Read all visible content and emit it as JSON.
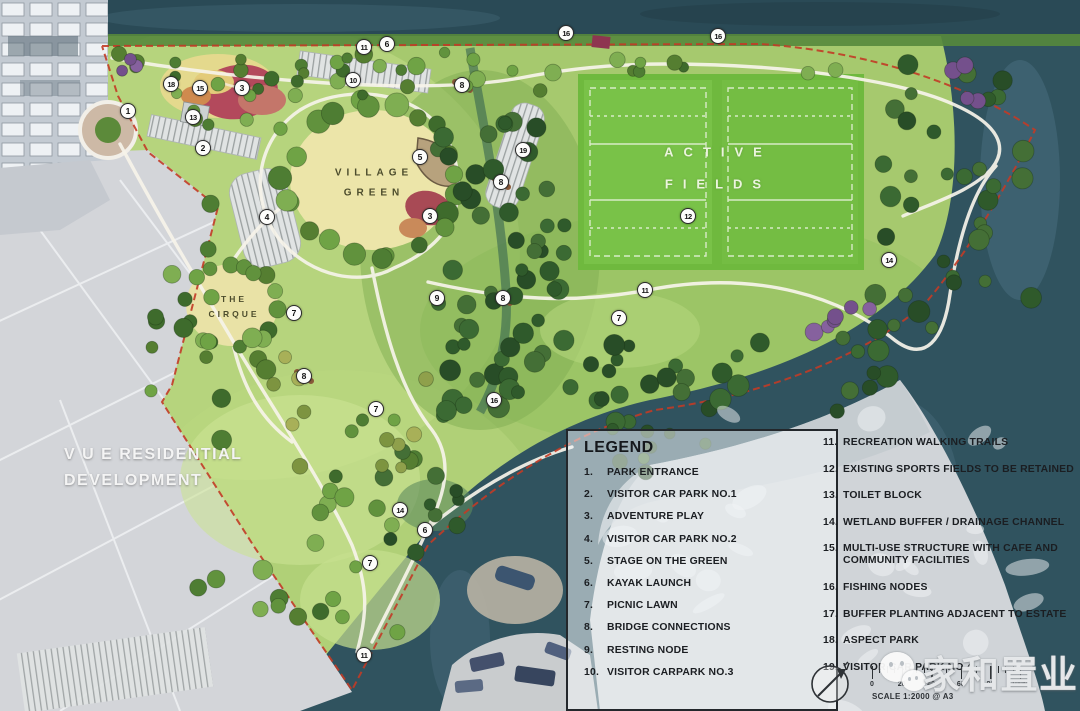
{
  "map": {
    "labels": {
      "active_fields_line1": "ACTIVE",
      "active_fields_line2": "FIELDS",
      "village_green_line1": "VILLAGE",
      "village_green_line2": "GREEN",
      "cirque_line1": "THE",
      "cirque_line2": "CIRQUE",
      "vue_line1": "V U E RESIDENTIAL",
      "vue_line2": "DEVELOPMENT"
    },
    "markers": [
      {
        "n": "1",
        "x": 128,
        "y": 111
      },
      {
        "n": "18",
        "x": 171,
        "y": 84
      },
      {
        "n": "15",
        "x": 200,
        "y": 88
      },
      {
        "n": "3",
        "x": 242,
        "y": 88
      },
      {
        "n": "13",
        "x": 193,
        "y": 117
      },
      {
        "n": "2",
        "x": 203,
        "y": 148
      },
      {
        "n": "4",
        "x": 267,
        "y": 217
      },
      {
        "n": "10",
        "x": 353,
        "y": 80
      },
      {
        "n": "11",
        "x": 364,
        "y": 47
      },
      {
        "n": "6",
        "x": 387,
        "y": 44
      },
      {
        "n": "8",
        "x": 462,
        "y": 85
      },
      {
        "n": "16",
        "x": 566,
        "y": 33
      },
      {
        "n": "16",
        "x": 718,
        "y": 36
      },
      {
        "n": "5",
        "x": 420,
        "y": 157
      },
      {
        "n": "3",
        "x": 430,
        "y": 216
      },
      {
        "n": "8",
        "x": 501,
        "y": 182
      },
      {
        "n": "19",
        "x": 523,
        "y": 150
      },
      {
        "n": "12",
        "x": 688,
        "y": 216
      },
      {
        "n": "14",
        "x": 889,
        "y": 260
      },
      {
        "n": "9",
        "x": 437,
        "y": 298
      },
      {
        "n": "8",
        "x": 503,
        "y": 298
      },
      {
        "n": "7",
        "x": 294,
        "y": 313
      },
      {
        "n": "8",
        "x": 304,
        "y": 376
      },
      {
        "n": "7",
        "x": 376,
        "y": 409
      },
      {
        "n": "7",
        "x": 619,
        "y": 318
      },
      {
        "n": "11",
        "x": 645,
        "y": 290
      },
      {
        "n": "16",
        "x": 494,
        "y": 400
      },
      {
        "n": "14",
        "x": 400,
        "y": 510
      },
      {
        "n": "6",
        "x": 425,
        "y": 530
      },
      {
        "n": "7",
        "x": 370,
        "y": 563
      },
      {
        "n": "11",
        "x": 364,
        "y": 655
      }
    ]
  },
  "legend": {
    "title": "LEGEND",
    "items_left": [
      {
        "num": "1.",
        "label": "PARK ENTRANCE"
      },
      {
        "num": "2.",
        "label": "VISITOR CAR PARK NO.1"
      },
      {
        "num": "3.",
        "label": "ADVENTURE PLAY"
      },
      {
        "num": "4.",
        "label": "VISITOR CAR PARK NO.2"
      },
      {
        "num": "5.",
        "label": "STAGE ON THE GREEN"
      },
      {
        "num": "6.",
        "label": "KAYAK LAUNCH"
      },
      {
        "num": "7.",
        "label": "PICNIC LAWN"
      },
      {
        "num": "8.",
        "label": "BRIDGE CONNECTIONS"
      },
      {
        "num": "9.",
        "label": "RESTING NODE"
      },
      {
        "num": "10.",
        "label": "VISITOR CARPARK NO.3"
      }
    ],
    "items_right": [
      {
        "num": "11.",
        "label": "RECREATION WALKING TRAILS"
      },
      {
        "num": "12.",
        "label": "EXISTING SPORTS FIELDS TO BE RETAINED"
      },
      {
        "num": "13.",
        "label": "TOILET BLOCK"
      },
      {
        "num": "14.",
        "label": "WETLAND BUFFER / DRAINAGE CHANNEL"
      },
      {
        "num": "15.",
        "label": "MULTI-USE STRUCTURE WITH CAFE AND COMMUNITY FACILITIES"
      },
      {
        "num": "16.",
        "label": "FISHING NODES"
      },
      {
        "num": "17.",
        "label": "BUFFER PLANTING ADJACENT TO ESTATE"
      },
      {
        "num": "18.",
        "label": "ASPECT PARK"
      },
      {
        "num": "19.",
        "label": "VISITOR CAR PARK NO.4"
      }
    ]
  },
  "scale_bar": {
    "tick_labels": [
      "0",
      "20",
      "40",
      "60",
      "80",
      "100M"
    ],
    "caption": "SCALE 1:2000 @ A3"
  },
  "watermark": {
    "text": "家和置业"
  },
  "colors": {
    "water": "#30535f",
    "park_green": "#a6c96e",
    "field_green": "#6fb93e",
    "boundary_red": "#c23b26",
    "grey_land": "#d0d4d8"
  }
}
